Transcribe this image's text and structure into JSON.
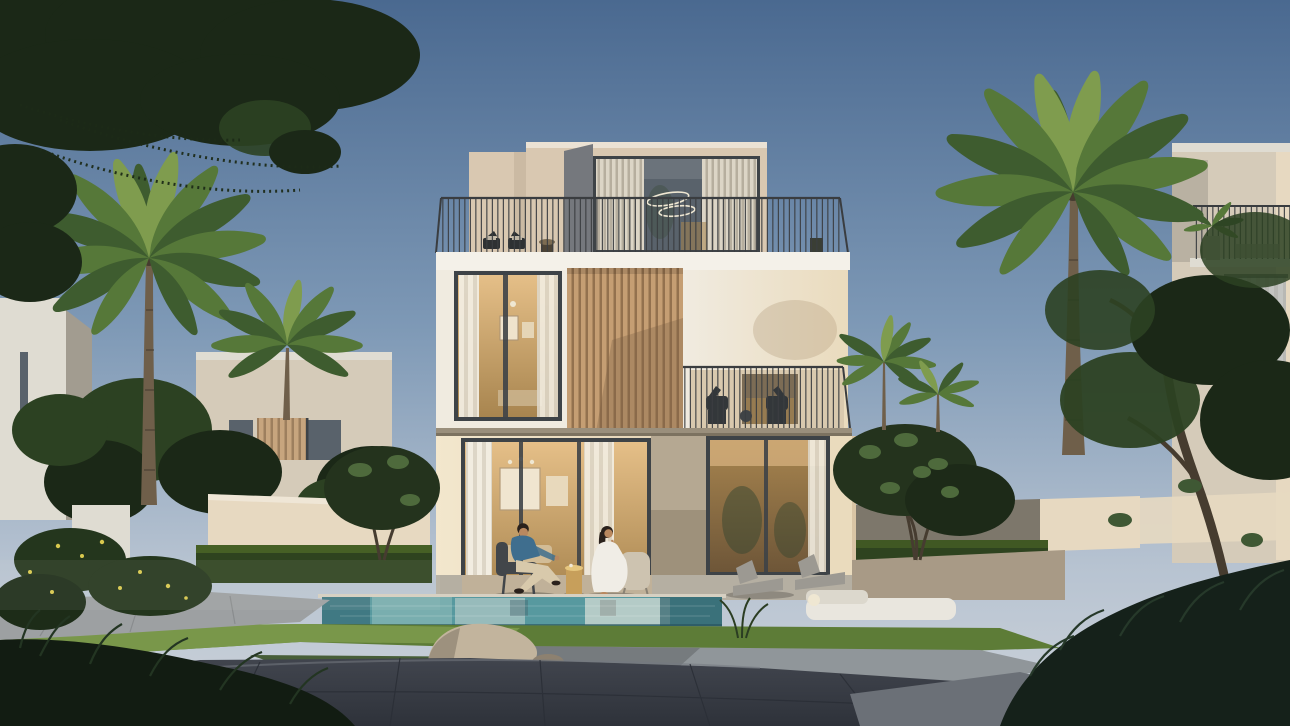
{
  "scene": {
    "description": "Photorealistic dusk rendering of a modern three-storey villa with a glass penthouse, rooftop terrace, timber-slat cladding and warm glowing interiors; a man in a blue shirt and a woman in a white dress sit beside a swimming pool; palms, hedges, lawns, gravel, a rock and neighbouring villas frame the scene.",
    "time_of_day": "dusk",
    "objects": [
      "main villa",
      "glass penthouse",
      "rooftop terrace",
      "terrace railing",
      "ring pendant light",
      "timber slat cladding",
      "balcony with chairs",
      "ground-floor glass doors",
      "swimming pool",
      "seated man",
      "seated woman",
      "gold side table",
      "sun loungers",
      "outdoor daybed",
      "sphere lamp",
      "palm trees",
      "frangipani trees",
      "garden hedges",
      "garden walls",
      "lawn",
      "gravel bed",
      "rock",
      "stone pathways",
      "neighbouring villas",
      "tree canopy"
    ]
  },
  "palette": {
    "sky-top": "#4a6990",
    "sky-mid": "#7e99b6",
    "sky-low": "#b7c3d1",
    "sky-horizon": "#cdd3da",
    "canopy-dark": "#1b2817",
    "canopy-mid": "#2c4122",
    "canopy-lit": "#44612c",
    "palm-dark": "#3e5c2f",
    "palm-mid": "#567839",
    "palm-lit": "#7f9c4e",
    "trunk": "#6f5f4a",
    "trunk-dark": "#463c2f",
    "villa-cream": "#f0ebe0",
    "parapet-white": "#f4f1e9",
    "beige-lit": "#d9c8b1",
    "beige-shade": "#c2b09a",
    "slab-gray": "#75787d",
    "glass-frame": "#3e4347",
    "glass-dark": "#59626b",
    "glass-light": "#8b949c",
    "louver": "#dcd5c6",
    "louver-shadow": "#b6ae9e",
    "curtain": "#f2ede1",
    "curtain-shade": "#ddd6c7",
    "wood": "#c59e73",
    "wood-dark": "#93714e",
    "wall-warm": "#eadbbd",
    "wall-warm-deep": "#d9c5a5",
    "wall-glow": "#f3e7cd",
    "interior-warm": "#e5bf88",
    "interior-deep": "#a8854f",
    "interior-dark": "#6e5638",
    "railing": "#3a3d40",
    "ring-light": "#efe7d2",
    "neighbor-lit": "#dfdcd2",
    "neighbor-shade": "#a29c90",
    "neighbor-face": "#d5cbb9",
    "neighbor-warm": "#e7d9c1",
    "hedge": "#2e431f",
    "hedge-lit": "#4c6827",
    "grass-lit": "#7e9c4e",
    "grass": "#5d7c37",
    "grass-shade": "#3a5227",
    "pool-teal": "#57999f",
    "pool-mid": "#8fbcbb",
    "pool-light": "#ccd7d1",
    "pool-dark": "#2e5f6b",
    "coping": "#d6d0c2",
    "patio": "#b5afa2",
    "patio-warm": "#a89a86",
    "path-lit": "#9da0a2",
    "path-dark": "#41454e",
    "path-deep": "#2e323a",
    "gravel": "#90969a",
    "gravel-dark": "#6b7077",
    "rock": "#c2b49d",
    "rock-shade": "#8d8170",
    "skin": "#b9885f",
    "hair": "#2a211c",
    "shirt": "#3f6e8e",
    "pants": "#d8c9ab",
    "dress": "#f0ede6",
    "chair-dark": "#42464a",
    "chair-light": "#cdc3b0",
    "gold": "#c79f5b",
    "gold-lit": "#e6c67e",
    "lounger": "#9c9992",
    "daybed": "#e9e6de",
    "flower": "#d9c94e",
    "shadow": "#55514a"
  }
}
